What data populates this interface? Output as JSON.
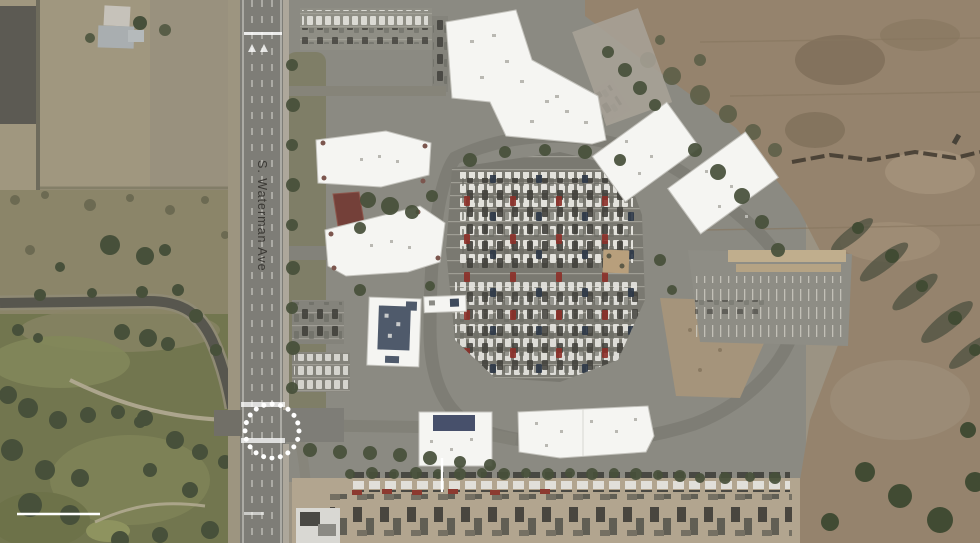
{
  "figure": {
    "kind": "aerial satellite photograph",
    "street_label": "S. Waterman Ave"
  },
  "annotations": {
    "highlight_circle": {
      "style": "dotted",
      "color": "#ffffff",
      "subject": "intersection on S. Waterman Ave"
    },
    "scale_bar": {
      "color": "#ffffff"
    },
    "building_leader_line": {
      "color": "#ffffff"
    }
  },
  "palette": {
    "road_gray": "#7e7d77",
    "asphalt": "#8b8a82",
    "parking": "#7a7971",
    "roof_white": "#f5f5f2",
    "tree_green": "#47503a",
    "lawn_green": "#7d7b63",
    "golf_green": "#72764f",
    "field_tan": "#a0977f",
    "scrub": "#8b8569",
    "dirt_brown": "#95836d",
    "yard_tan": "#b2a58f",
    "carport_tan": "#c0ae8d",
    "pavilion_red": "#744039",
    "label_dark": "#2f2d29",
    "annotation_white": "#ffffff"
  },
  "features": {
    "white_roof_building_count": 9,
    "areas": [
      "agricultural fields",
      "golf course",
      "S. Waterman Ave",
      "office park with central parking lot",
      "covered parking carports",
      "graded dirt site",
      "truck and trailer yard"
    ]
  }
}
